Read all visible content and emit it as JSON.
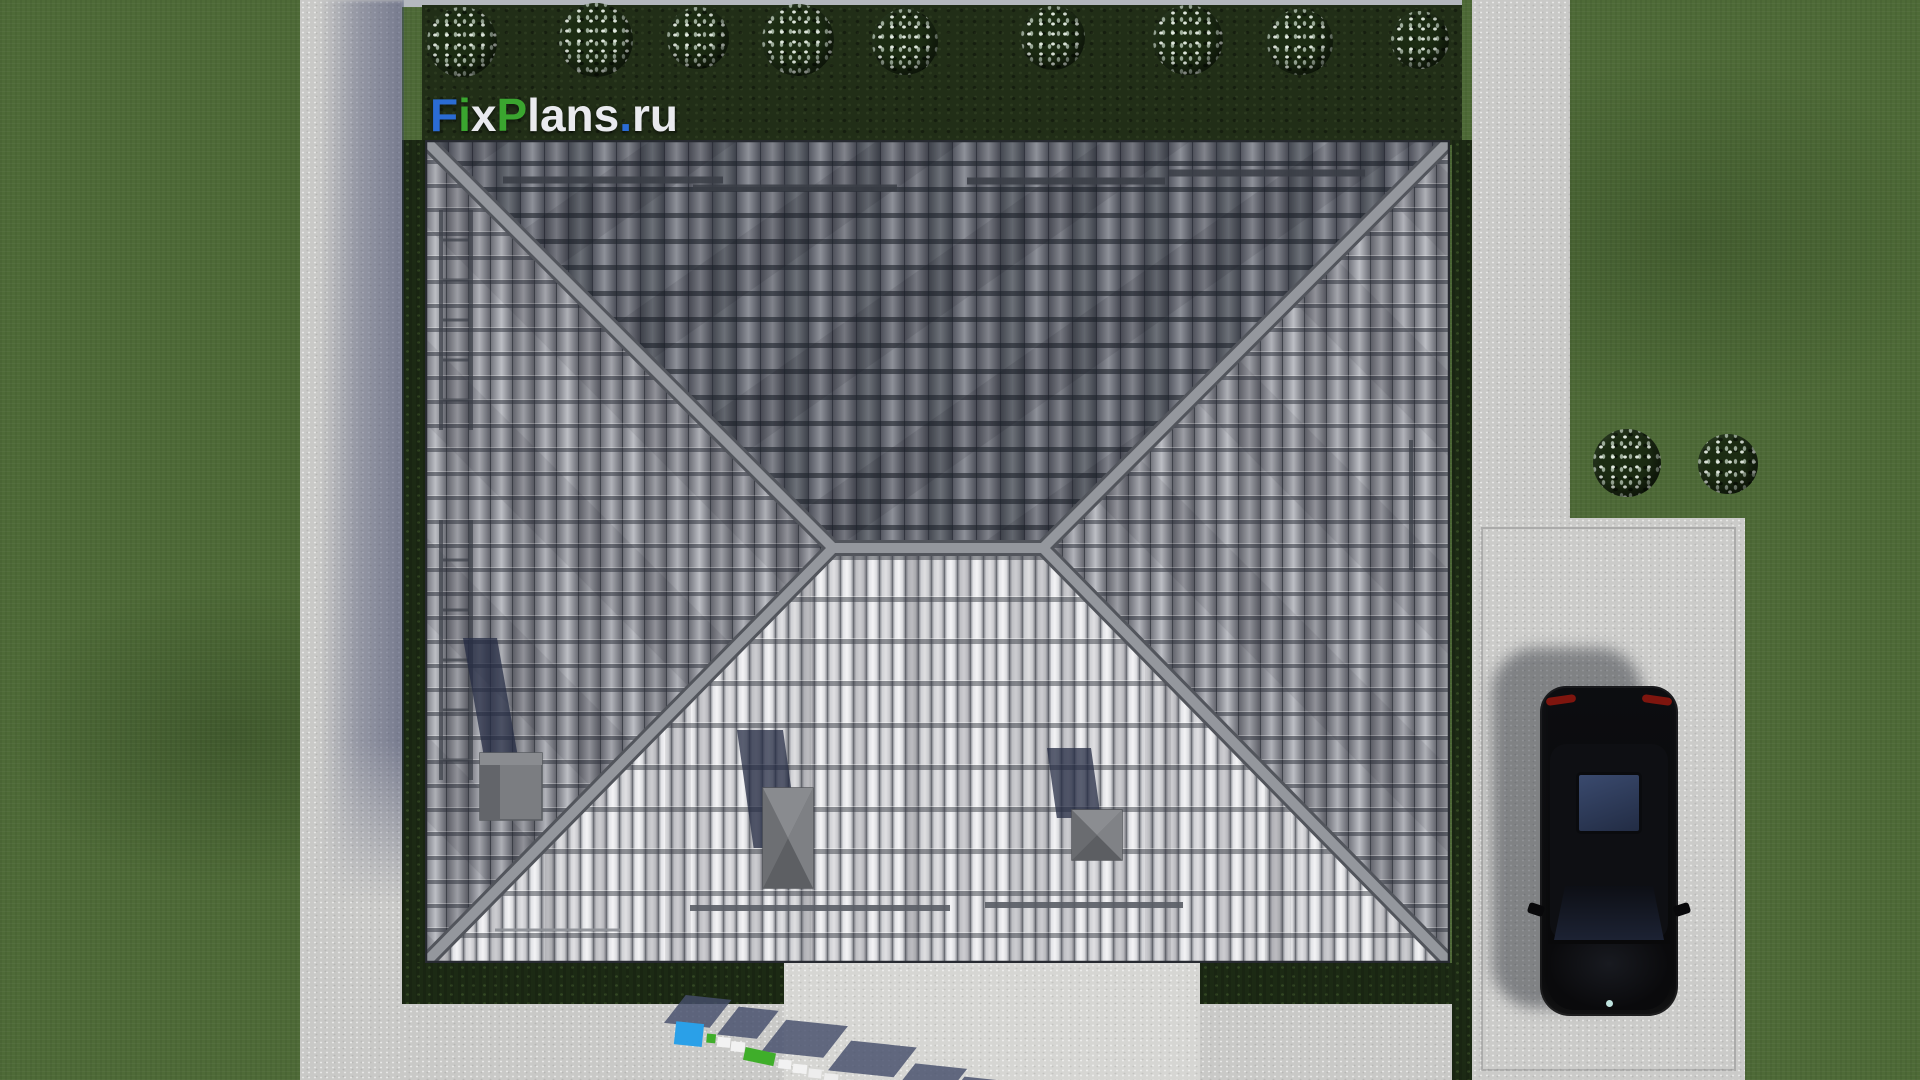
{
  "brand": {
    "top_watermark": {
      "segments": [
        {
          "text": "F",
          "color": "#2b6cd4"
        },
        {
          "text": "i",
          "color": "#3aa52f"
        },
        {
          "text": "x",
          "color": "#e9eaee"
        },
        {
          "text": "P",
          "color": "#3aa52f"
        },
        {
          "text": "lans",
          "color": "#e9eaee"
        },
        {
          "text": ".",
          "color": "#2b6cd4"
        },
        {
          "text": "ru",
          "color": "#e9eaee"
        }
      ]
    },
    "ground_watermark": {
      "text": "FixPlans.ru"
    }
  },
  "scene": {
    "description": "Top-down 3D architectural render: hip-roof house with tiled roof, hedge with nine flowering shrubs, lawns, concrete paths, driveway with parked black car and two flower bushes",
    "colors": {
      "lawn": "#4e6a37",
      "hedge": "#212e17",
      "pavement": "#c9c9c7",
      "walk_pad": "#d6d6d3",
      "roof_face_top": "#5a5d66",
      "roof_face_sides": "#9a9da4",
      "roof_face_bottom": "#dfdfe2",
      "roof_ridge": "#94979d",
      "chimney": "#737579",
      "cast_shadow": "#454e6b",
      "car_body": "#0b0b0d",
      "car_sunroof": "#2e3a55",
      "car_taillight": "#7e150e",
      "flowers": "#e8f0e6",
      "ground_logo_blue": "#2aa0e8",
      "ground_logo_green": "#3fae2a"
    }
  }
}
